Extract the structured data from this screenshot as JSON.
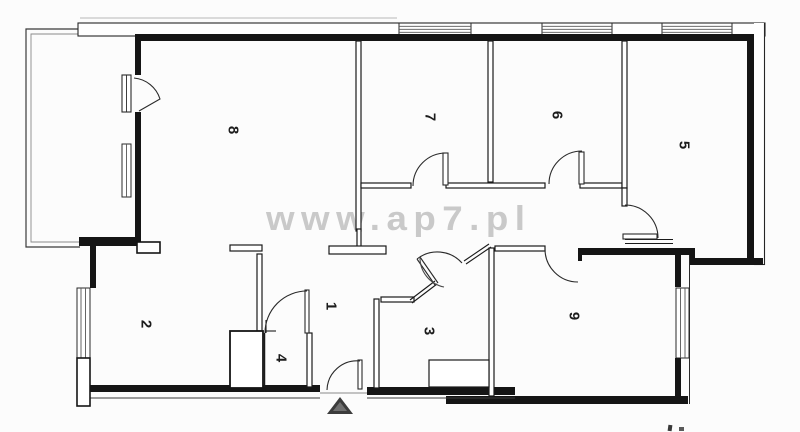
{
  "watermark": {
    "text": "www.ap7.pl",
    "color": "#c9c9c9"
  },
  "rooms": [
    {
      "number": "8"
    },
    {
      "number": "7"
    },
    {
      "number": "6"
    },
    {
      "number": "5"
    },
    {
      "number": "2"
    },
    {
      "number": "1"
    },
    {
      "number": "4"
    },
    {
      "number": "3"
    },
    {
      "number": "9"
    }
  ],
  "colors": {
    "wall": "#151515",
    "thin_wall_stroke": "#1a1a1a",
    "watermark": "#c9c9c9",
    "entrance_marker": "#3c3c3c",
    "background": "#fcfcfc"
  },
  "icons": [
    {
      "name": "entrance-arrow-icon",
      "meaning": "apartment entrance marker"
    }
  ]
}
